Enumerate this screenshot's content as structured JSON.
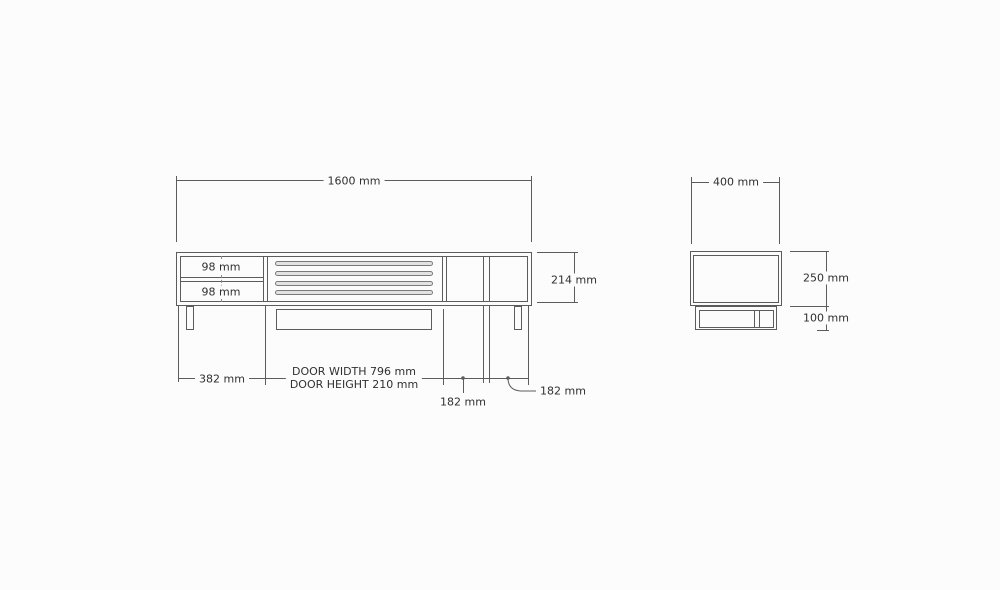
{
  "page": {
    "background": "#fcfcfc",
    "line_color": "#5c5c5c",
    "text_color": "#303030",
    "slat_fill": "#e3e3e3"
  },
  "front_view": {
    "width": "1600 mm",
    "height": "214 mm",
    "drawer_top": "98 mm",
    "drawer_bottom": "98 mm",
    "left_section_width": "382 mm",
    "door_width_note": "DOOR WIDTH 796 mm",
    "door_height_note": "DOOR HEIGHT 210 mm",
    "right_gap_1": "182 mm",
    "right_gap_2": "182 mm"
  },
  "side_view": {
    "depth": "400 mm",
    "body_height": "250 mm",
    "base_height": "100 mm"
  }
}
